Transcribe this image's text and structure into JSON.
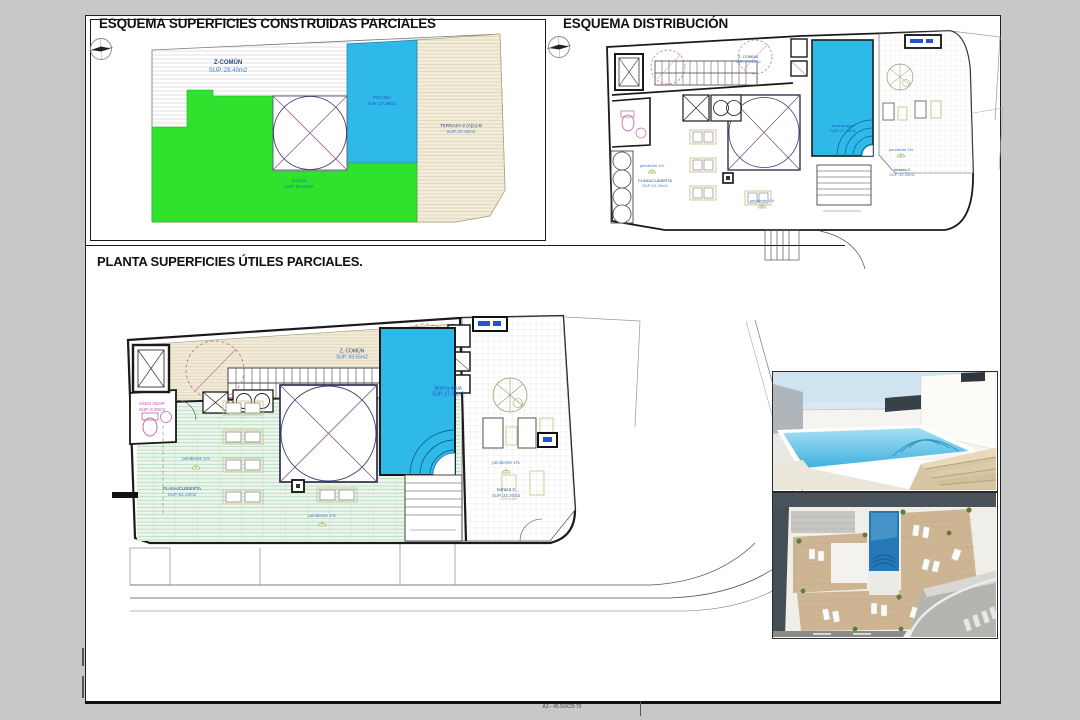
{
  "sheet": {
    "format_label": "A3 - 45.50X29.70"
  },
  "panel_construidas": {
    "title": "ESQUEMA SUPERFICIES CONSTRUIDAS PARCIALES",
    "zones": {
      "z_comun_name": "Z-COMÚN",
      "z_comun_sup": "SUP.:29.40m2",
      "piscina_name": "PISCINA",
      "piscina_sup": "SUP.:27.38m2",
      "terraza_name": "terraza",
      "terraza_sup": "SUP.:59.35m2",
      "terraza2_name": "TERRAZA-2 (A)(c)-B",
      "terraza2_sup": "SUP.:37.40m2"
    }
  },
  "panel_distribucion": {
    "title": "ESQUEMA DISTRIBUCIÓN",
    "labels": {
      "z_comun": "Z. COMÚN",
      "z_comun_sup": "SUP.:29.40m2",
      "lamina_agua": "lámina agua",
      "lamina_agua_sup": "SUP.:27.38m2",
      "pendiente": "pendiente 1%",
      "plana_cubierta": "PLANA/CUBIERTA",
      "plana_cubierta_sup": "SUP.:51.20m2",
      "terraza2": "terraza 2",
      "terraza2_sup": "SUP.:32.20m2"
    }
  },
  "panel_utiles": {
    "title": "PLANTA SUPERFICIES ÚTILES PARCIALES.",
    "labels": {
      "z_comun": "Z. COMÚN",
      "z_comun_sup": "SUP.:69.55m2",
      "aseo": "ASEO ADAP.",
      "aseo_sup": "SUP.:3.20m2",
      "lamina_agua": "lámina agua",
      "lamina_agua_sup": "SUP.:27.38m2",
      "pendiente": "pendiente 1%",
      "plana_cubierta": "PLANA/CUBIERTA",
      "plana_cubierta_sup": "SUP.:51.20m2",
      "terraza2": "terraza 2",
      "terraza2_sup": "SUP.:32.20m2"
    }
  },
  "colors": {
    "pool": "#2fb9e8",
    "green": "#2ee22e",
    "beige_terrace": "#f2ecda",
    "deck_green": "#ecf6ed",
    "wall": "#1a1a1a",
    "label_blue": "#3f7fd6"
  }
}
